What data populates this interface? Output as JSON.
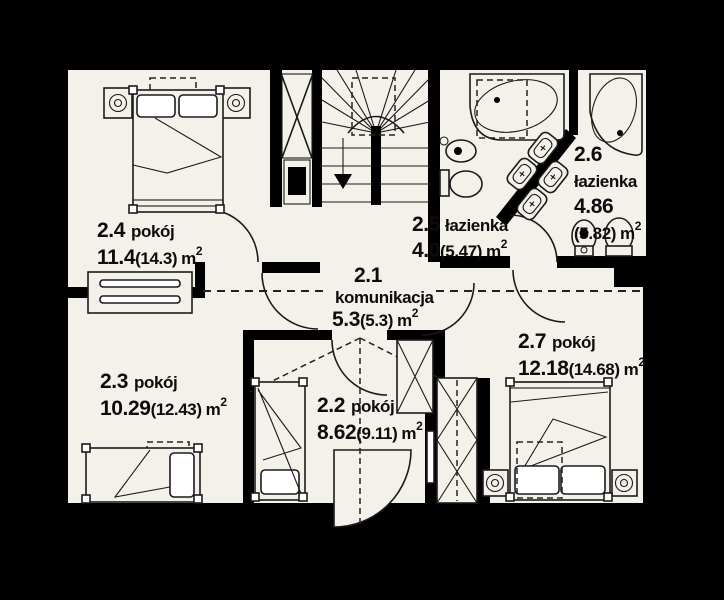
{
  "plan": {
    "unit": "m",
    "unit_sup": "2",
    "rooms": [
      {
        "id": "2.1",
        "name": "komunikacja",
        "area": "5.3",
        "alt": "(5.3)"
      },
      {
        "id": "2.2",
        "name": "pokój",
        "area": "8.62",
        "alt": "(9.11)"
      },
      {
        "id": "2.3",
        "name": "pokój",
        "area": "10.29",
        "alt": "(12.43)"
      },
      {
        "id": "2.4",
        "name": "pokój",
        "area": "11.4",
        "alt": "(14.3)"
      },
      {
        "id": "2.5",
        "name": "łazienka",
        "area": "4.0",
        "alt": "(5.47)"
      },
      {
        "id": "2.6",
        "name": "łazienka",
        "area": "4.86",
        "alt": "(5.82)"
      },
      {
        "id": "2.7",
        "name": "pokój",
        "area": "12.18",
        "alt": "(14.68)"
      }
    ],
    "colors": {
      "background": "#000000",
      "floor": "#f4f1ea",
      "wall": "#000000",
      "line": "#1b1b1b"
    }
  }
}
